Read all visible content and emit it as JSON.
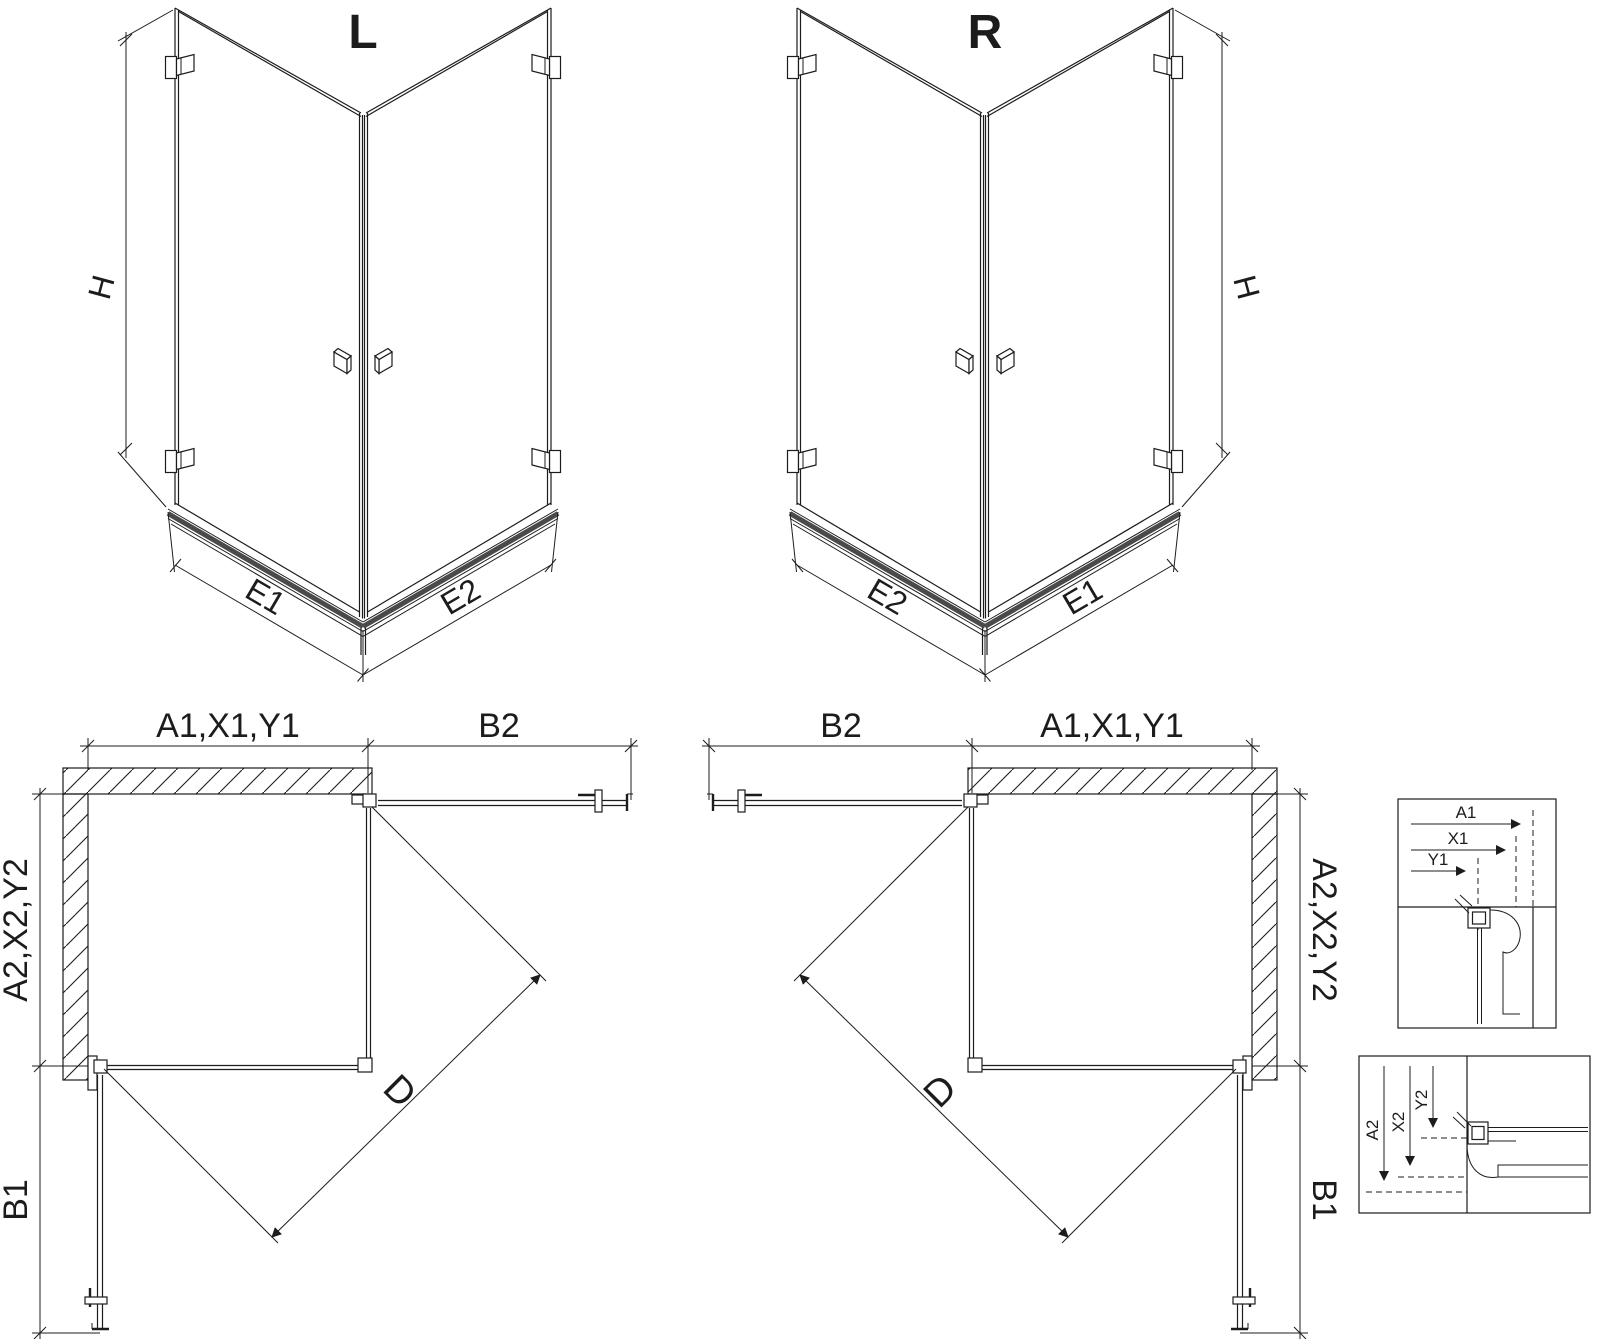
{
  "sheet": {
    "background": "#ffffff",
    "line_color": "#1c1c1c",
    "rail_color": "#4a4a4a"
  },
  "iso_left": {
    "title": "L",
    "dim_height": "H",
    "dim_base_left": "E1",
    "dim_base_right": "E2"
  },
  "iso_right": {
    "title": "R",
    "dim_height": "H",
    "dim_base_left": "E2",
    "dim_base_right": "E1"
  },
  "plan_left": {
    "dim_top_left": "A1,X1,Y1",
    "dim_top_right": "B2",
    "dim_side_upper": "A2,X2,Y2",
    "dim_side_lower": "B1",
    "dim_diagonal": "D"
  },
  "plan_right": {
    "dim_top_left": "B2",
    "dim_top_right": "A1,X1,Y1",
    "dim_side_upper": "A2,X2,Y2",
    "dim_side_lower": "B1",
    "dim_diagonal": "D"
  },
  "detail_upper": {
    "dims": [
      "A1",
      "X1",
      "Y1"
    ]
  },
  "detail_lower": {
    "dims": [
      "A2",
      "X2",
      "Y2"
    ]
  }
}
